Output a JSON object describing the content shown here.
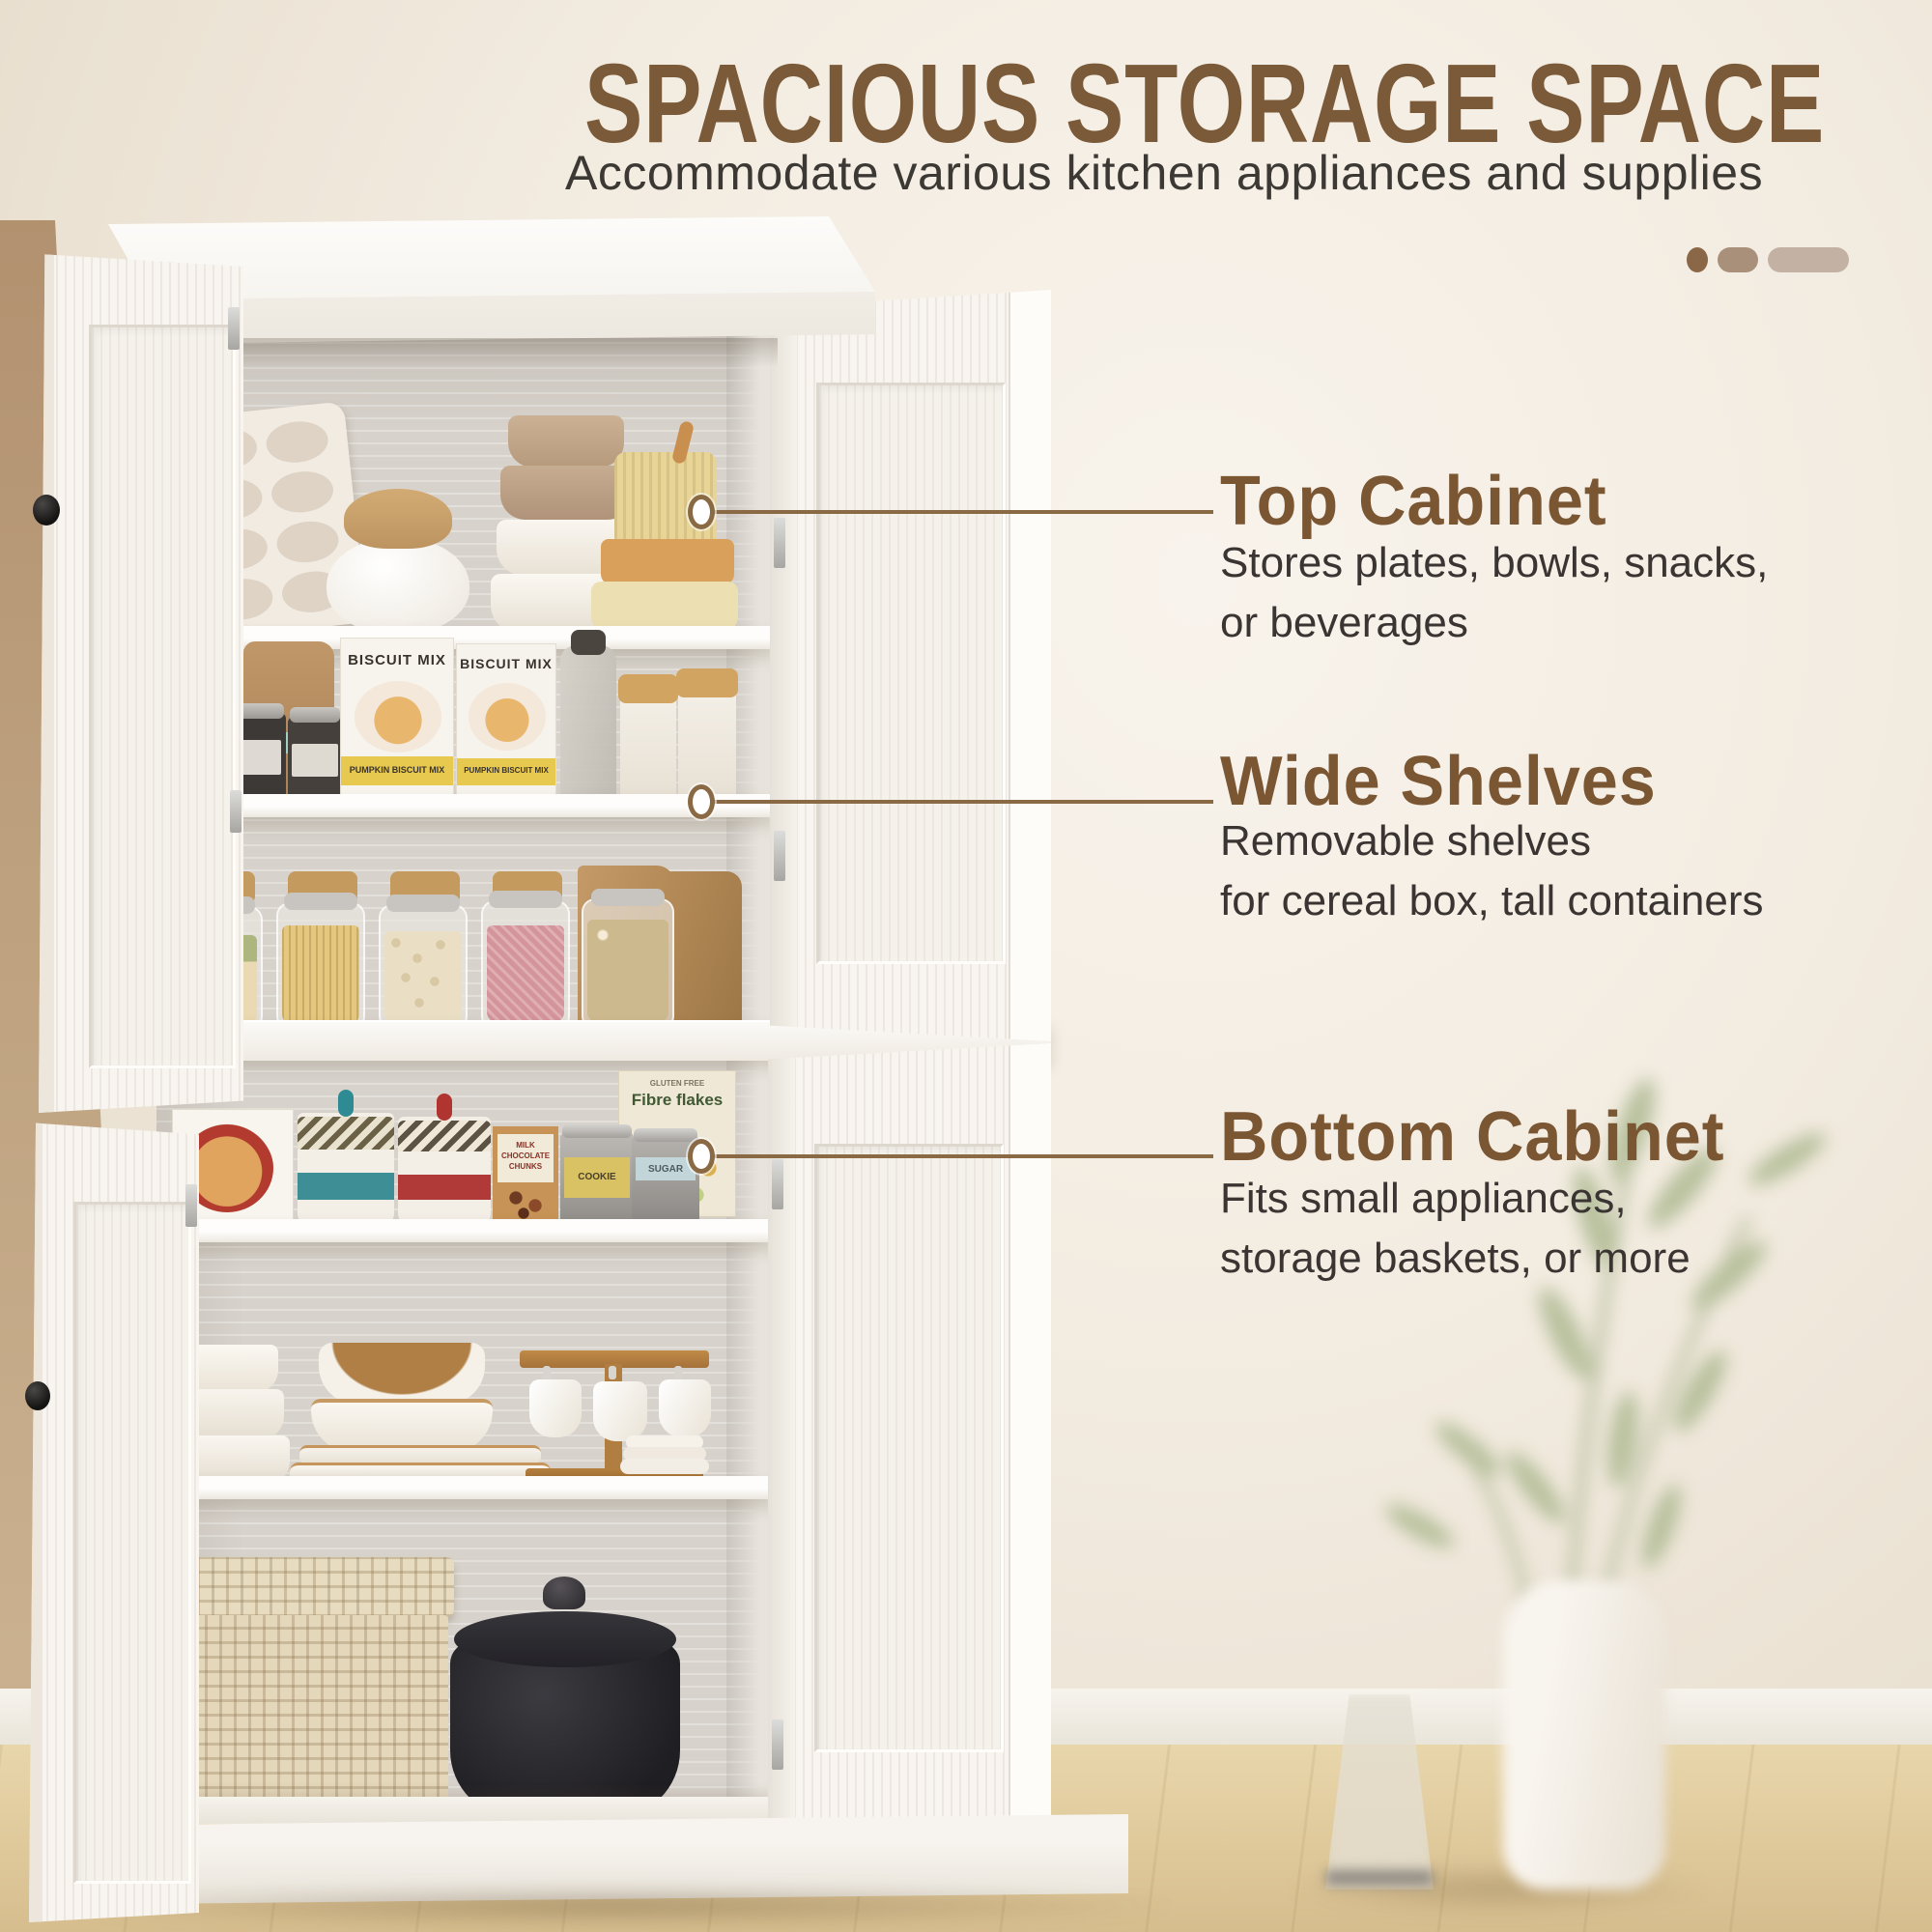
{
  "header": {
    "title": "SPACIOUS STORAGE SPACE",
    "subtitle": "Accommodate various kitchen appliances and supplies"
  },
  "pagination": {
    "count": 3,
    "active_index": 2,
    "colors": [
      "#8a6747",
      "#a9907b",
      "#c3b2a4"
    ]
  },
  "callouts": [
    {
      "heading": "Top Cabinet",
      "line1": "Stores plates, bowls, snacks,",
      "line2": "or beverages"
    },
    {
      "heading": "Wide Shelves",
      "line1": "Removable shelves",
      "line2": "for cereal box, tall containers"
    },
    {
      "heading": "Bottom Cabinet",
      "line1": "Fits small appliances,",
      "line2": "storage baskets, or more"
    }
  ],
  "cabinet": {
    "labels": {
      "biscuit_box": "BISCUIT MIX",
      "biscuit_box_band": "PUMPKIN BISCUIT MIX",
      "cereal_box": "Fibre flakes",
      "cereal_box_tag": "GLUTEN FREE",
      "chocolate_box": "MILK CHOCOLATE CHUNKS",
      "cookie_tin": "COOKIE",
      "sugar_tin": "SUGAR"
    },
    "shelves": [
      {
        "label": "top shelf",
        "items": [
          "cutting board",
          "muffin tray",
          "jar with cloth cover",
          "stacked bowls",
          "yellow ribbed bowls"
        ]
      },
      {
        "label": "second shelf",
        "items": [
          "kraft coffee bags",
          "spice tins",
          "biscuit mix boxes",
          "glass bottle",
          "wood-lid canisters"
        ]
      },
      {
        "label": "third shelf",
        "items": [
          "clip-top jars with grains and pasta",
          "kraft paper bags"
        ]
      },
      {
        "label": "fourth shelf",
        "items": [
          "cereal box",
          "striped canisters",
          "chocolate chunks box",
          "cookie tin",
          "sugar tin",
          "fibre flakes box"
        ]
      },
      {
        "label": "fifth shelf",
        "items": [
          "bowl stack",
          "wood-rim plates",
          "mug rack with cups",
          "saucers"
        ]
      },
      {
        "label": "cabinet floor",
        "items": [
          "woven storage box",
          "black dutch oven"
        ]
      }
    ]
  },
  "colors": {
    "title_brown": "#7a5a38",
    "accent_brown": "#7a5633",
    "leader_line": "#8a6a45",
    "body_text": "#3a3532",
    "wall": "#f3ecE1",
    "floor": "#dfc99b"
  }
}
